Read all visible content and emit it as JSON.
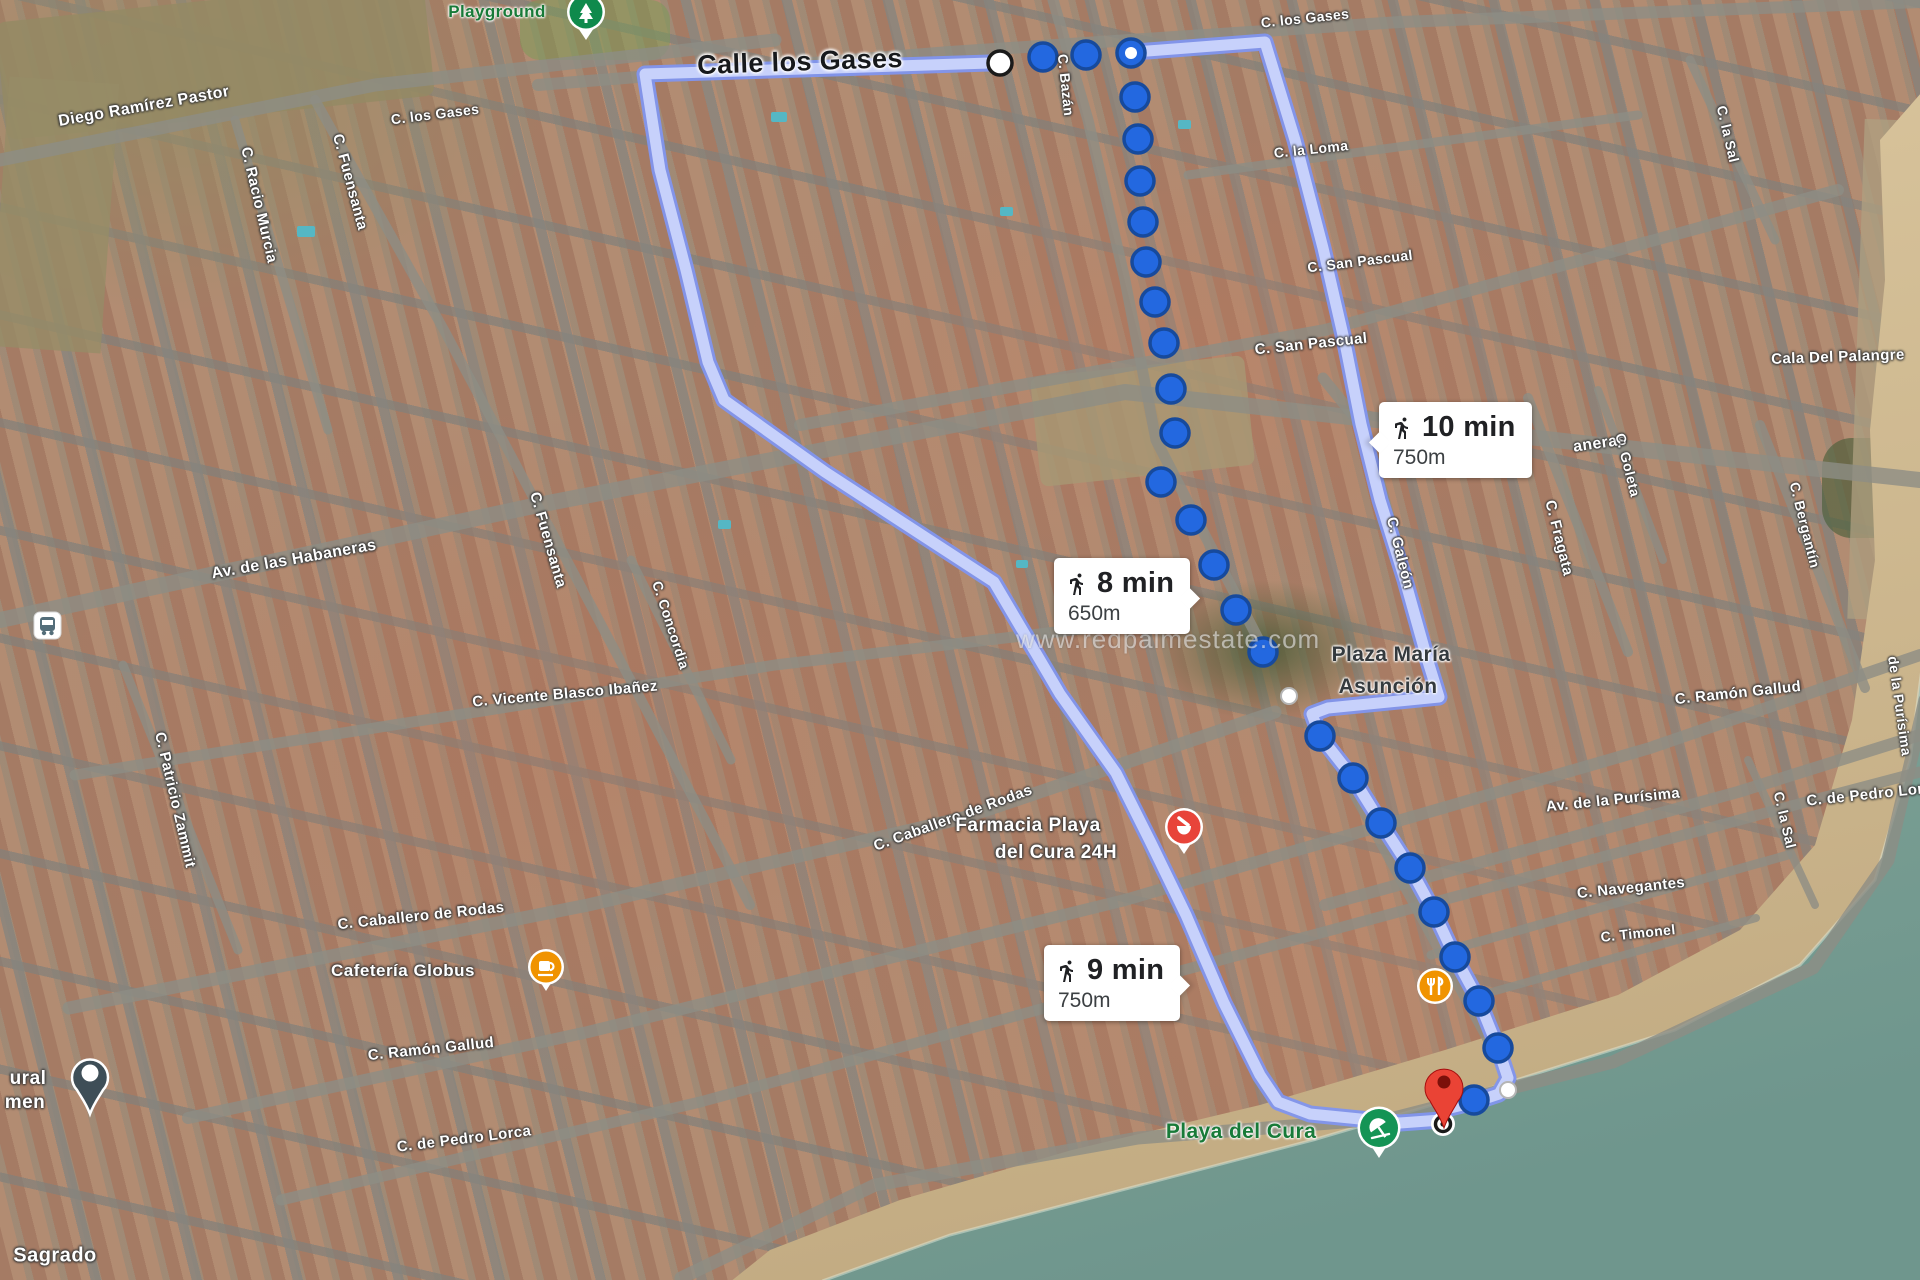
{
  "map": {
    "watermark": "www.redpalmestate.com",
    "badges": [
      {
        "time": "10 min",
        "distance": "750m"
      },
      {
        "time": "8 min",
        "distance": "650m"
      },
      {
        "time": "9 min",
        "distance": "750m"
      }
    ],
    "markers": {
      "origin": "Calle los Gases",
      "destination": "Playa del Cura"
    },
    "icon_colors": {
      "route_dot_blue": "#2368e0",
      "route_band_light": "#c7d1fb",
      "route_band_edge": "#8195ee",
      "destination_pin_red": "#EA4335",
      "poi_green": "#149455",
      "poi_orange": "#f09300",
      "poi_pharmacy_red": "#e8443a"
    },
    "labels": [
      {
        "name": "street-label-diego-ramirez-pastor",
        "text": "Diego Ramírez Pastor",
        "x": 144,
        "y": 107,
        "rot": -10,
        "size": 16
      },
      {
        "name": "street-label-racio-murcia",
        "text": "C. Racio Murcia",
        "x": 259,
        "y": 205,
        "rot": 77,
        "size": 15
      },
      {
        "name": "street-label-fuensanta-north",
        "text": "C. Fuensanta",
        "x": 350,
        "y": 182,
        "rot": 75,
        "size": 15
      },
      {
        "name": "street-label-los-gases-west",
        "text": "C. los Gases",
        "x": 435,
        "y": 114,
        "rot": -7,
        "size": 14
      },
      {
        "name": "poi-label-playground",
        "text": "Playground",
        "x": 497,
        "y": 12,
        "rot": 0,
        "size": 17,
        "cls": "poi-green",
        "inter": true
      },
      {
        "name": "origin-label",
        "text": "Calle los Gases",
        "x": 800,
        "y": 62,
        "rot": -2,
        "size": 27,
        "cls": "origin",
        "inter": true
      },
      {
        "name": "street-label-bazan",
        "text": "C. Bazán",
        "x": 1066,
        "y": 85,
        "rot": 84,
        "size": 14
      },
      {
        "name": "street-label-los-gases-east",
        "text": "C. los Gases",
        "x": 1305,
        "y": 18,
        "rot": -6,
        "size": 14
      },
      {
        "name": "street-label-la-loma",
        "text": "C. la Loma",
        "x": 1311,
        "y": 149,
        "rot": -6,
        "size": 14
      },
      {
        "name": "street-label-san-pascual-east",
        "text": "C. San Pascual",
        "x": 1360,
        "y": 261,
        "rot": -7,
        "size": 14
      },
      {
        "name": "street-label-san-pascual",
        "text": "C. San Pascual",
        "x": 1311,
        "y": 344,
        "rot": -6,
        "size": 15
      },
      {
        "name": "street-label-la-sal-north",
        "text": "C. la Sal",
        "x": 1728,
        "y": 134,
        "rot": 77,
        "size": 14
      },
      {
        "name": "poi-label-cala-del-palangre",
        "text": "Cala Del Palangre",
        "x": 1838,
        "y": 357,
        "rot": -2,
        "size": 15,
        "inter": true
      },
      {
        "name": "street-label-habaneras",
        "text": "Av. de las Habaneras",
        "x": 294,
        "y": 560,
        "rot": -10,
        "size": 16
      },
      {
        "name": "street-label-habaneras-fragment",
        "text": "aneras",
        "x": 1600,
        "y": 444,
        "rot": -8,
        "size": 16
      },
      {
        "name": "street-label-fuensanta-mid",
        "text": "C. Fuensanta",
        "x": 548,
        "y": 540,
        "rot": 74,
        "size": 15
      },
      {
        "name": "street-label-concordia",
        "text": "C. Concordia",
        "x": 671,
        "y": 625,
        "rot": 72,
        "size": 14
      },
      {
        "name": "street-label-galeon",
        "text": "C. Galeón",
        "x": 1400,
        "y": 553,
        "rot": 76,
        "size": 15
      },
      {
        "name": "street-label-fragata",
        "text": "C. Fragata",
        "x": 1559,
        "y": 538,
        "rot": 76,
        "size": 15
      },
      {
        "name": "street-label-goleta",
        "text": "C. Goleta",
        "x": 1628,
        "y": 465,
        "rot": 76,
        "size": 14
      },
      {
        "name": "street-label-bergantin",
        "text": "C. Bergantín",
        "x": 1805,
        "y": 525,
        "rot": 76,
        "size": 14
      },
      {
        "name": "street-label-vicente-blasco-ibanez",
        "text": "C. Vicente Blasco Ibañez",
        "x": 565,
        "y": 694,
        "rot": -5,
        "size": 15
      },
      {
        "name": "street-label-patricio-zammit",
        "text": "C. Patricio Zammit",
        "x": 175,
        "y": 800,
        "rot": 77,
        "size": 15
      },
      {
        "name": "poi-label-plaza-maria-line1",
        "text": "Plaza María",
        "x": 1391,
        "y": 655,
        "rot": 0,
        "size": 21,
        "cls": "plaza",
        "inter": true
      },
      {
        "name": "poi-label-plaza-maria-line2",
        "text": "Asunción",
        "x": 1388,
        "y": 687,
        "rot": 0,
        "size": 21,
        "cls": "plaza",
        "inter": true
      },
      {
        "name": "street-label-ramon-gallud-east",
        "text": "C. Ramón Gallud",
        "x": 1738,
        "y": 693,
        "rot": -6,
        "size": 15
      },
      {
        "name": "street-label-caballero-de-rodas",
        "text": "C. Caballero de Rodas",
        "x": 421,
        "y": 916,
        "rot": -6,
        "size": 15
      },
      {
        "name": "street-label-caballero-de-rodas-diag",
        "text": "C. Caballero de Rodas",
        "x": 953,
        "y": 818,
        "rot": -20,
        "size": 15
      },
      {
        "name": "poi-label-farmacia-line1",
        "text": "Farmacia Playa",
        "x": 1028,
        "y": 826,
        "rot": 0,
        "size": 19,
        "cls": "poi-white",
        "inter": true
      },
      {
        "name": "poi-label-farmacia-line2",
        "text": "del Cura 24H",
        "x": 1056,
        "y": 853,
        "rot": 0,
        "size": 19,
        "cls": "poi-white",
        "inter": true
      },
      {
        "name": "poi-label-cafeteria-globus",
        "text": "Cafetería Globus",
        "x": 403,
        "y": 971,
        "rot": 0,
        "size": 17,
        "cls": "poi-white",
        "inter": true
      },
      {
        "name": "street-label-ramon-gallud",
        "text": "C. Ramón Gallud",
        "x": 431,
        "y": 1049,
        "rot": -6,
        "size": 15
      },
      {
        "name": "poi-label-fragment-ural",
        "text": "ural",
        "x": 28,
        "y": 1079,
        "rot": 0,
        "size": 19,
        "cls": "poi-white"
      },
      {
        "name": "poi-label-fragment-men",
        "text": "men",
        "x": 25,
        "y": 1103,
        "rot": 0,
        "size": 19,
        "cls": "poi-white"
      },
      {
        "name": "street-label-pedro-lorca",
        "text": "C. de Pedro Lorca",
        "x": 464,
        "y": 1139,
        "rot": -7,
        "size": 15
      },
      {
        "name": "street-label-av-purisima",
        "text": "Av. de la Purísima",
        "x": 1613,
        "y": 800,
        "rot": -6,
        "size": 15
      },
      {
        "name": "street-label-la-sal-south",
        "text": "C. la Sal",
        "x": 1785,
        "y": 820,
        "rot": 77,
        "size": 14
      },
      {
        "name": "street-label-purisima-vertical",
        "text": "de la Purísima",
        "x": 1900,
        "y": 706,
        "rot": 82,
        "size": 14
      },
      {
        "name": "street-label-navegantes",
        "text": "C. Navegantes",
        "x": 1631,
        "y": 888,
        "rot": -6,
        "size": 15
      },
      {
        "name": "street-label-timonel",
        "text": "C. Timonel",
        "x": 1638,
        "y": 933,
        "rot": -6,
        "size": 14
      },
      {
        "name": "street-label-pedro-lorca-east",
        "text": "C. de Pedro Lor",
        "x": 1865,
        "y": 795,
        "rot": -6,
        "size": 15
      },
      {
        "name": "poi-label-sagrado",
        "text": "Sagrado",
        "x": 55,
        "y": 1256,
        "rot": 0,
        "size": 20,
        "cls": "poi-white",
        "inter": true
      },
      {
        "name": "poi-label-playa-del-cura",
        "text": "Playa del Cura",
        "x": 1241,
        "y": 1132,
        "rot": 0,
        "size": 21,
        "cls": "poi-green",
        "inter": true
      }
    ]
  }
}
